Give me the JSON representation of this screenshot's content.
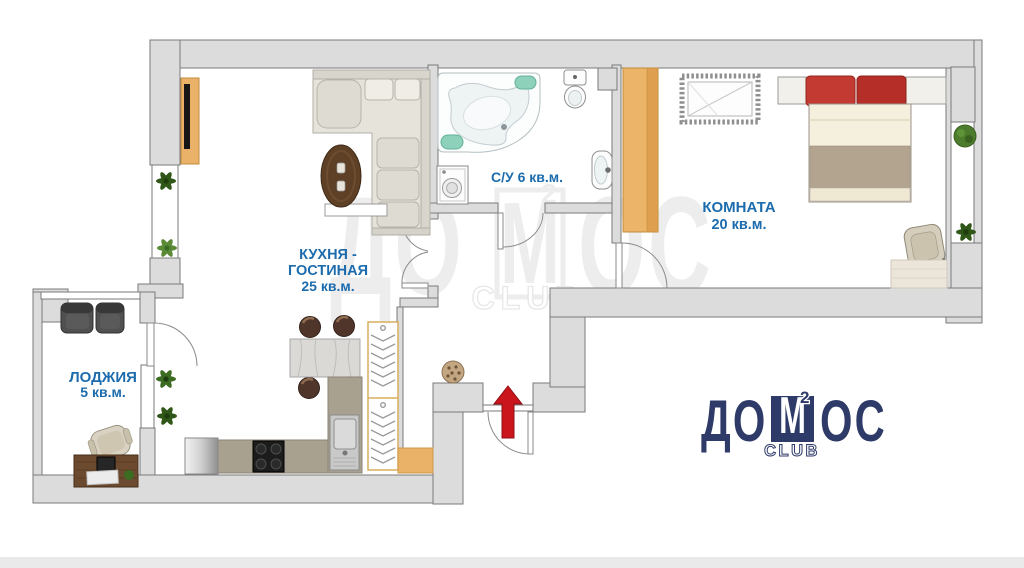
{
  "page": {
    "width": 1024,
    "height": 568,
    "background": "#ffffff",
    "type": "apartment floor plan"
  },
  "colors": {
    "wall_fill": "#dcdcdc",
    "wall_stroke": "#7a7a7a",
    "label_blue": "#1c6cad",
    "logo_navy": "#2e3a68",
    "watermark_gray": "#ededed",
    "arrow_red": "#c9151b",
    "wood_tan": "#eab168",
    "plant_green": "#3c6b22",
    "spa_teal": "#8ed1bb"
  },
  "rooms": [
    {
      "id": "kitchen-living",
      "name": "КУХНЯ - ГОСТИНАЯ",
      "area": "25 кв.м."
    },
    {
      "id": "bathroom",
      "name": "С/У",
      "area": "6 кв.м."
    },
    {
      "id": "bedroom",
      "name": "КОМНАТА",
      "area": "20 кв.м."
    },
    {
      "id": "loggia",
      "name": "ЛОДЖИЯ",
      "area": "5 кв.м."
    }
  ],
  "labels": {
    "kitchen_l1": "КУХНЯ -",
    "kitchen_l2": "ГОСТИНАЯ",
    "kitchen_l3": "25 кв.м.",
    "bathroom_l1": "С/У  6 кв.м.",
    "bedroom_l1": "КОМНАТА",
    "bedroom_l2": "20 кв.м.",
    "loggia_l1": "ЛОДЖИЯ",
    "loggia_l2": "5 кв.м."
  },
  "watermark": {
    "left": "ДО",
    "m": "М",
    "right": "ОС",
    "sup": "2",
    "club": "CLUB"
  },
  "logo": {
    "left": "ДО",
    "m": "М",
    "right": "ОС",
    "sup": "2",
    "club": "CLUB"
  },
  "furniture_icons": [
    "corner-sofa-icon",
    "tv-stand-icon",
    "dining-table-icon",
    "console-shelf-icon",
    "bar-table-icon",
    "bar-stool-icon",
    "fridge-icon",
    "stove-icon",
    "kitchen-sink-icon",
    "hanger-closet-icon",
    "corner-bathtub-icon",
    "washing-machine-icon",
    "toilet-icon",
    "bathroom-sink-icon",
    "wardrobe-icon",
    "crib-icon",
    "double-bed-icon",
    "armchair-icon",
    "rug-icon",
    "desk-icon",
    "office-chair-icon",
    "balcony-chair-icon",
    "plant-icon",
    "pouf-icon",
    "entrance-arrow-icon"
  ]
}
